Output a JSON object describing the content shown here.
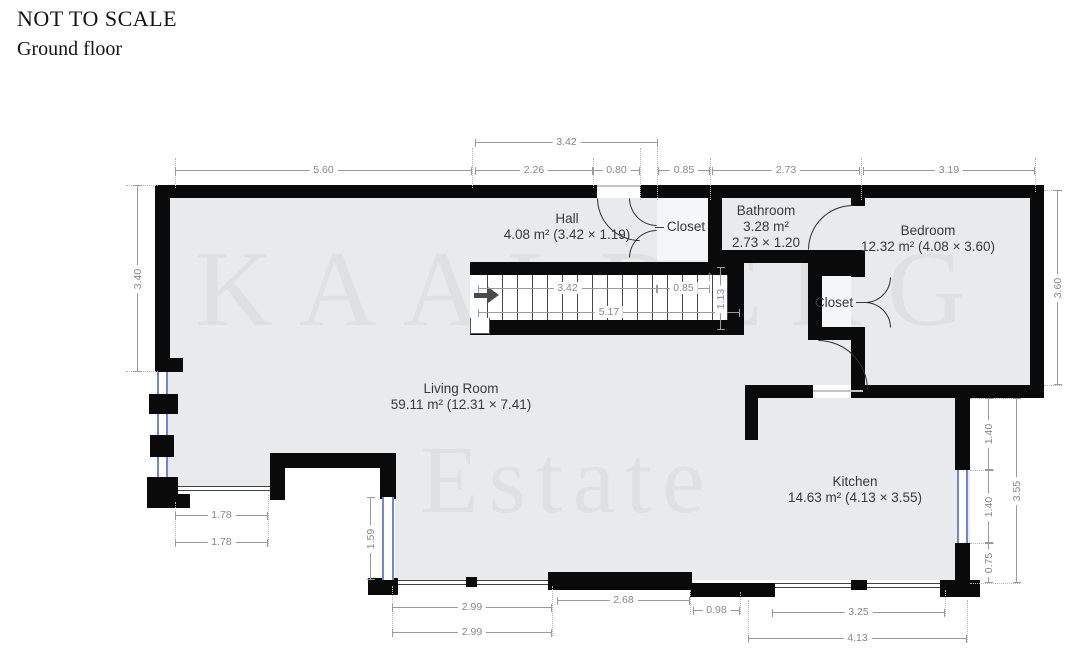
{
  "header": {
    "scale_note": "NOT TO SCALE",
    "floor_label": "Ground floor"
  },
  "watermark": {
    "line1": "KAALBERG",
    "line2": "Estate"
  },
  "rooms": {
    "hall": {
      "name": "Hall",
      "area": "4.08 m² (3.42 × 1.19)"
    },
    "closet_hall": {
      "name": "Closet"
    },
    "bathroom": {
      "name": "Bathroom",
      "area": "3.28 m²",
      "size": "2.73 × 1.20"
    },
    "bedroom": {
      "name": "Bedroom",
      "area": "12.32 m² (4.08 × 3.60)"
    },
    "closet_bedroom": {
      "name": "Closet"
    },
    "living_room": {
      "name": "Living Room",
      "area": "59.11 m² (12.31 × 7.41)"
    },
    "kitchen": {
      "name": "Kitchen",
      "area": "14.63 m² (4.13 × 3.55)"
    }
  },
  "stairs": {
    "up_arrow": "↑"
  },
  "colors": {
    "wall": "#0a0a0a",
    "room_fill": "#e8eaec",
    "window": "#7583d6",
    "dimension": "#9a9a9a"
  },
  "dimensions": [
    {
      "label": "3.42",
      "orient": "h",
      "x": 475,
      "y": 142,
      "len": 183
    },
    {
      "label": "5.60",
      "orient": "h",
      "x": 175,
      "y": 170,
      "len": 297
    },
    {
      "label": "2.26",
      "orient": "h",
      "x": 475,
      "y": 170,
      "len": 118
    },
    {
      "label": "0.80",
      "orient": "h",
      "x": 593,
      "y": 170,
      "len": 47
    },
    {
      "label": "0.85",
      "orient": "h",
      "x": 658,
      "y": 170,
      "len": 52
    },
    {
      "label": "2.73",
      "orient": "h",
      "x": 712,
      "y": 170,
      "len": 148
    },
    {
      "label": "3.19",
      "orient": "h",
      "x": 863,
      "y": 170,
      "len": 172
    },
    {
      "label": "3.40",
      "orient": "v",
      "x": 137,
      "y": 185,
      "len": 187
    },
    {
      "label": "3.60",
      "orient": "v",
      "x": 1057,
      "y": 190,
      "len": 195
    },
    {
      "label": "3.42",
      "orient": "h",
      "x": 478,
      "y": 288,
      "len": 179
    },
    {
      "label": "0.85",
      "orient": "h",
      "x": 657,
      "y": 288,
      "len": 53
    },
    {
      "label": "5.17",
      "orient": "h",
      "x": 478,
      "y": 312,
      "len": 262
    },
    {
      "label": "1.13",
      "orient": "v",
      "x": 720,
      "y": 267,
      "len": 63
    },
    {
      "label": "1.78",
      "orient": "h",
      "x": 175,
      "y": 515,
      "len": 93
    },
    {
      "label": "1.78",
      "orient": "h",
      "x": 175,
      "y": 542,
      "len": 93
    },
    {
      "label": "1.59",
      "orient": "v",
      "x": 370,
      "y": 497,
      "len": 83
    },
    {
      "label": "2.99",
      "orient": "h",
      "x": 392,
      "y": 607,
      "len": 160
    },
    {
      "label": "2.99",
      "orient": "h",
      "x": 392,
      "y": 632,
      "len": 160
    },
    {
      "label": "2.68",
      "orient": "h",
      "x": 557,
      "y": 600,
      "len": 133
    },
    {
      "label": "0.98",
      "orient": "h",
      "x": 693,
      "y": 610,
      "len": 47
    },
    {
      "label": "3.25",
      "orient": "h",
      "x": 772,
      "y": 612,
      "len": 173
    },
    {
      "label": "4.13",
      "orient": "h",
      "x": 748,
      "y": 638,
      "len": 219
    },
    {
      "label": "1.40",
      "orient": "v",
      "x": 988,
      "y": 398,
      "len": 72
    },
    {
      "label": "1.40",
      "orient": "v",
      "x": 988,
      "y": 470,
      "len": 73
    },
    {
      "label": "0.75",
      "orient": "v",
      "x": 988,
      "y": 543,
      "len": 40
    },
    {
      "label": "3.55",
      "orient": "v",
      "x": 1016,
      "y": 398,
      "len": 185
    }
  ]
}
